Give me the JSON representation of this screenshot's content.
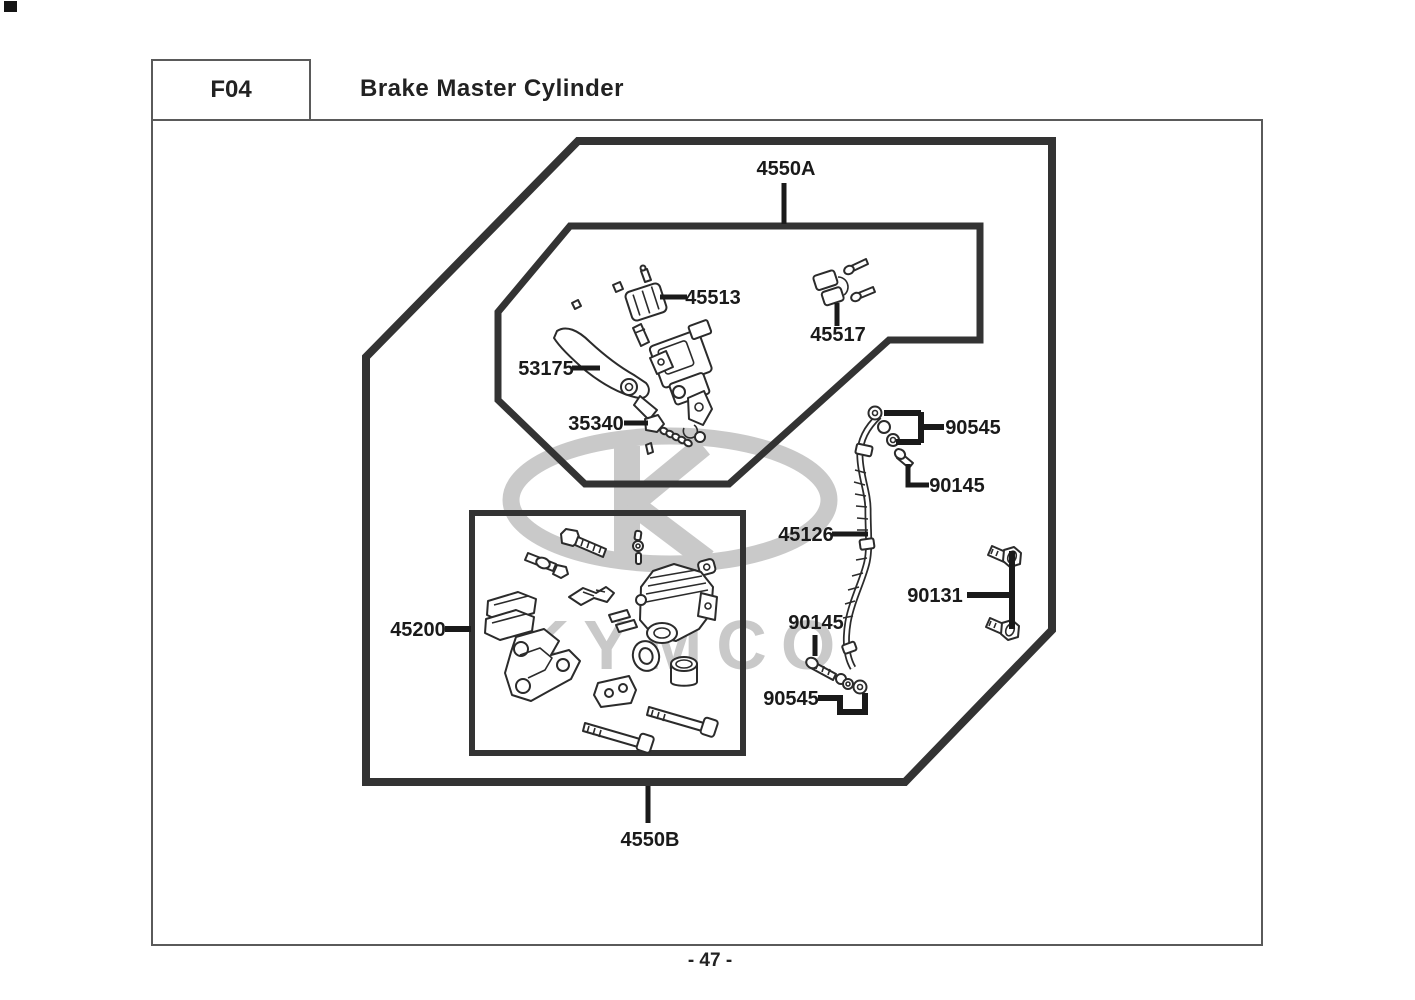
{
  "header": {
    "section_code": "F04",
    "title": "Brake Master Cylinder"
  },
  "footer": {
    "page_number": "- 47 -"
  },
  "watermark": {
    "brand": "KYMCO"
  },
  "colors": {
    "line": "#333333",
    "label": "#1a1a1a",
    "watermark": "#c9c9c9"
  },
  "diagram": {
    "part_labels": [
      {
        "text": "4550A"
      },
      {
        "text": "45513"
      },
      {
        "text": "45517"
      },
      {
        "text": "53175"
      },
      {
        "text": "35340"
      },
      {
        "text": "90545"
      },
      {
        "text": "90145"
      },
      {
        "text": "45126"
      },
      {
        "text": "90131"
      },
      {
        "text": "45200"
      },
      {
        "text": "90145"
      },
      {
        "text": "90545"
      },
      {
        "text": "4550B"
      }
    ]
  }
}
